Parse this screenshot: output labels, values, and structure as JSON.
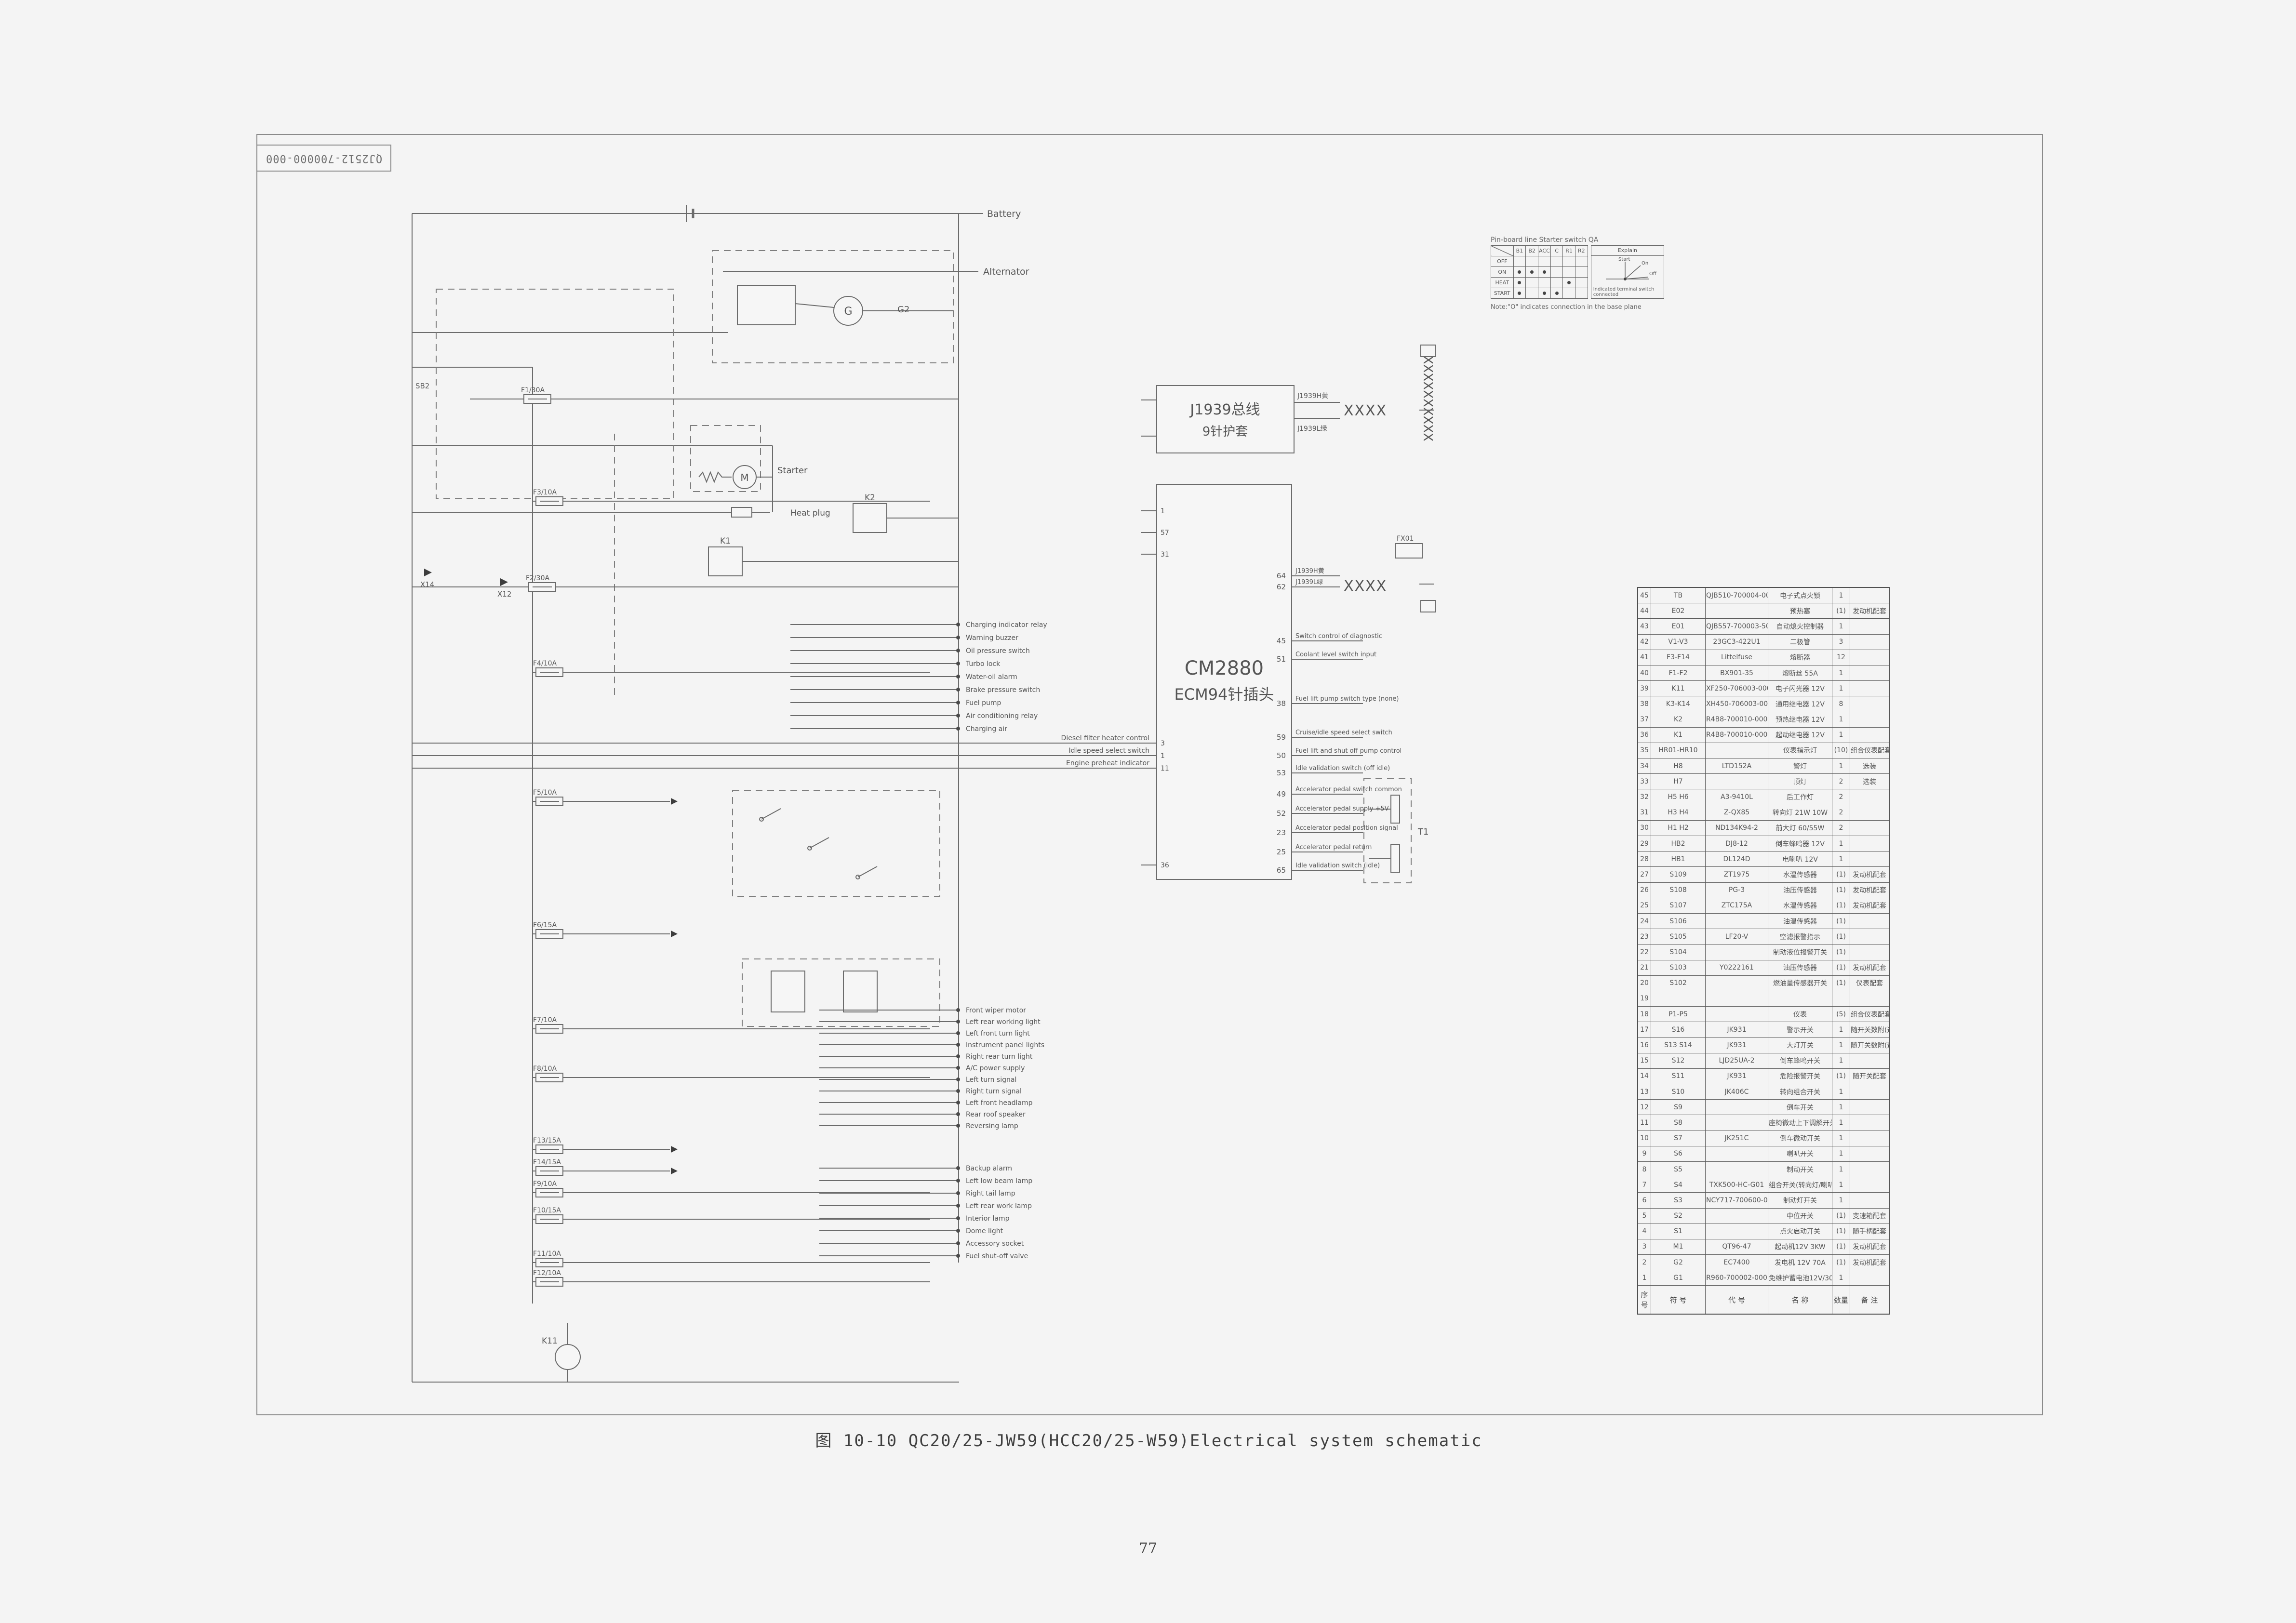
{
  "sheet": {
    "corner_label": "QJ2512-700000-000",
    "title": "图 10-10   QC20/25-JW59(HCC20/25-W59)Electrical system schematic",
    "page_number": "77"
  },
  "starter_switch_table": {
    "title": "Pin-board line Starter switch QA",
    "terminals": [
      "B1",
      "B2",
      "ACC",
      "C",
      "R1",
      "R2"
    ],
    "rows": [
      {
        "name": "OFF",
        "marks": [
          0,
          0,
          0,
          0,
          0,
          0
        ]
      },
      {
        "name": "ON",
        "marks": [
          1,
          1,
          1,
          0,
          0,
          0
        ]
      },
      {
        "name": "HEAT",
        "marks": [
          1,
          0,
          0,
          0,
          1,
          0
        ]
      },
      {
        "name": "START",
        "marks": [
          1,
          0,
          1,
          1,
          0,
          0
        ]
      }
    ],
    "explain": {
      "title": "Explain",
      "positions": [
        "Start",
        "On",
        "Off"
      ],
      "caption": "Indicated terminal switch connected"
    },
    "note": "Note:\"O\" indicates connection in the base plane"
  },
  "schematic": {
    "j1939_box": {
      "line1": "J1939总线",
      "line2": "9针护套"
    },
    "ecm_box": {
      "line1": "CM2880",
      "line2": "ECM94针插头"
    },
    "wire_labels": {
      "canh": "J1939H黄",
      "canl": "J1939L绿"
    },
    "component_labels": {
      "battery": "Battery",
      "alternator": "Alternator",
      "starter": "Starter",
      "heat_plug": "Heat plug",
      "g2": "G2",
      "g": "G",
      "m": "M",
      "k1": "K1",
      "k2": "K2",
      "k11": "K11",
      "t1": "T1",
      "fx01": "FX01",
      "sb2": "SB2",
      "x14": "X14",
      "x12": "X12"
    },
    "fuse_labels": [
      "F1/30A",
      "F2/30A",
      "F3/10A",
      "F4/10A",
      "F5/10A",
      "F6/15A",
      "F7/10A",
      "F8/10A",
      "F13/15A",
      "F14/15A",
      "F9/10A",
      "F10/15A",
      "F11/10A",
      "F12/10A"
    ],
    "bus_loads_top": [
      "Charging indicator relay",
      "Warning buzzer",
      "Oil pressure switch",
      "Turbo lock",
      "Water-oil alarm",
      "Brake pressure switch",
      "Fuel pump",
      "Air conditioning relay",
      "Charging air"
    ],
    "bus_loads_mid": [
      "Front wiper motor",
      "Left rear working light",
      "Left front turn light",
      "Instrument panel lights",
      "Right rear turn light",
      "A/C power supply",
      "Left turn signal",
      "Right turn signal",
      "Left front headlamp",
      "Rear roof speaker",
      "Reversing lamp"
    ],
    "bus_loads_bottom": [
      "Backup alarm",
      "Left low beam lamp",
      "Right tail lamp",
      "Left rear work lamp",
      "Interior lamp",
      "Dome light",
      "Accessory socket",
      "Fuel shut-off valve"
    ],
    "long_lines": [
      {
        "label": "Diesel filter heater control",
        "pin": "3"
      },
      {
        "label": "Idle speed select switch",
        "pin": "1"
      },
      {
        "label": "Engine preheat indicator",
        "pin": "11"
      }
    ],
    "ecm_pins_left": [
      {
        "num": "1"
      },
      {
        "num": "57"
      },
      {
        "num": "31"
      },
      {
        "num": "36"
      }
    ],
    "ecm_pins_right": [
      {
        "num": "64",
        "label": "J1939H黄"
      },
      {
        "num": "62",
        "label": "J1939L绿"
      },
      {
        "num": "45",
        "label": "Switch control of diagnostic"
      },
      {
        "num": "51",
        "label": "Coolant level switch input"
      },
      {
        "num": "38",
        "label": "Fuel lift pump switch type (none)"
      },
      {
        "num": "59",
        "label": "Cruise/idle speed select switch"
      },
      {
        "num": "50",
        "label": "Fuel lift and shut off pump control"
      },
      {
        "num": "53",
        "label": "Idle validation switch (off idle)"
      },
      {
        "num": "49",
        "label": "Accelerator pedal switch common"
      },
      {
        "num": "52",
        "label": "Accelerator pedal supply +5V"
      },
      {
        "num": "23",
        "label": "Accelerator pedal position signal"
      },
      {
        "num": "25",
        "label": "Accelerator pedal return"
      },
      {
        "num": "65",
        "label": "Idle validation switch (idle)"
      }
    ]
  },
  "parts_table": {
    "headers": [
      "序\n号",
      "符 号",
      "代 号",
      "名 称",
      "数量",
      "备 注"
    ],
    "rows": [
      [
        "45",
        "TB",
        "QJB510-700004-000",
        "电子式点火锁",
        "1",
        ""
      ],
      [
        "44",
        "E02",
        "",
        "预热塞",
        "(1)",
        "发动机配套"
      ],
      [
        "43",
        "E01",
        "QJB557-700003-500",
        "自动熄火控制器",
        "1",
        ""
      ],
      [
        "42",
        "V1-V3",
        "23GC3-422U1",
        "二极管",
        "3",
        ""
      ],
      [
        "41",
        "F3-F14",
        "Littelfuse",
        "熔断器",
        "12",
        ""
      ],
      [
        "40",
        "F1-F2",
        "BX901-35",
        "熔断丝 55A",
        "1",
        ""
      ],
      [
        "39",
        "K11",
        "XF250-706003-000",
        "电子闪光器 12V",
        "1",
        ""
      ],
      [
        "38",
        "K3-K14",
        "XH450-706003-000",
        "通用继电器 12V",
        "8",
        ""
      ],
      [
        "37",
        "K2",
        "R4B8-700010-000",
        "预热继电器 12V",
        "1",
        ""
      ],
      [
        "36",
        "K1",
        "R4B8-700010-000",
        "起动继电器 12V",
        "1",
        ""
      ],
      [
        "35",
        "HR01-HR10",
        "",
        "仪表指示灯",
        "(10)",
        "组合仪表配套"
      ],
      [
        "34",
        "H8",
        "LTD152A",
        "警灯",
        "1",
        "选装"
      ],
      [
        "33",
        "H7",
        "",
        "顶灯",
        "2",
        "选装"
      ],
      [
        "32",
        "H5 H6",
        "A3-9410L",
        "后工作灯",
        "2",
        ""
      ],
      [
        "31",
        "H3 H4",
        "Z-QX85",
        "转向灯 21W 10W",
        "2",
        ""
      ],
      [
        "30",
        "H1 H2",
        "ND134K94-2",
        "前大灯 60/55W",
        "2",
        ""
      ],
      [
        "29",
        "HB2",
        "DJ8-12",
        "倒车蜂鸣器 12V",
        "1",
        ""
      ],
      [
        "28",
        "HB1",
        "DL124D",
        "电喇叭 12V",
        "1",
        ""
      ],
      [
        "27",
        "S109",
        "ZT1975",
        "水温传感器",
        "(1)",
        "发动机配套"
      ],
      [
        "26",
        "S108",
        "PG-3",
        "油压传感器",
        "(1)",
        "发动机配套"
      ],
      [
        "25",
        "S107",
        "ZTC175A",
        "水温传感器",
        "(1)",
        "发动机配套"
      ],
      [
        "24",
        "S106",
        "",
        "油温传感器",
        "(1)",
        ""
      ],
      [
        "23",
        "S105",
        "LF20-V",
        "空滤报警指示",
        "(1)",
        ""
      ],
      [
        "22",
        "S104",
        "",
        "制动液位报警开关",
        "(1)",
        ""
      ],
      [
        "21",
        "S103",
        "Y0222161",
        "油压传感器",
        "(1)",
        "发动机配套"
      ],
      [
        "20",
        "S102",
        "",
        "燃油量传感器开关",
        "(1)",
        "仪表配套"
      ],
      [
        "19",
        "",
        "",
        "",
        "",
        ""
      ],
      [
        "18",
        "P1-P5",
        "",
        "仪表",
        "(5)",
        "组合仪表配套"
      ],
      [
        "17",
        "S16",
        "JK931",
        "警示开关",
        "1",
        "随开关数附(选配)"
      ],
      [
        "16",
        "S13 S14",
        "JK931",
        "大灯开关",
        "1",
        "随开关数附(选配)"
      ],
      [
        "15",
        "S12",
        "LJD25UA-2",
        "倒车蜂鸣开关",
        "1",
        ""
      ],
      [
        "14",
        "S11",
        "JK931",
        "危险报警开关",
        "(1)",
        "随开关配套"
      ],
      [
        "13",
        "S10",
        "JK406C",
        "转向组合开关",
        "1",
        ""
      ],
      [
        "12",
        "S9",
        "",
        "倒车开关",
        "1",
        ""
      ],
      [
        "11",
        "S8",
        "",
        "座椅微动上下调解开关",
        "1",
        ""
      ],
      [
        "10",
        "S7",
        "JK251C",
        "倒车微动开关",
        "1",
        ""
      ],
      [
        "9",
        "S6",
        "",
        "喇叭开关",
        "1",
        ""
      ],
      [
        "8",
        "S5",
        "",
        "制动开关",
        "1",
        ""
      ],
      [
        "7",
        "S4",
        "TXK500-HC-G01",
        "组合开关(转向灯/喇叭)",
        "1",
        ""
      ],
      [
        "6",
        "S3",
        "NCY717-700600-001",
        "制动灯开关",
        "1",
        ""
      ],
      [
        "5",
        "S2",
        "",
        "中位开关",
        "(1)",
        "变速箱配套"
      ],
      [
        "4",
        "S1",
        "",
        "点火启动开关",
        "(1)",
        "随手柄配套"
      ],
      [
        "3",
        "M1",
        "QT96-47",
        "起动机12V 3KW",
        "(1)",
        "发动机配套"
      ],
      [
        "2",
        "G2",
        "EC7400",
        "发电机 12V 70A",
        "(1)",
        "发动机配套"
      ],
      [
        "1",
        "G1",
        "R960-700002-000",
        "免维护蓄电池12V/30Ah",
        "1",
        ""
      ]
    ]
  }
}
